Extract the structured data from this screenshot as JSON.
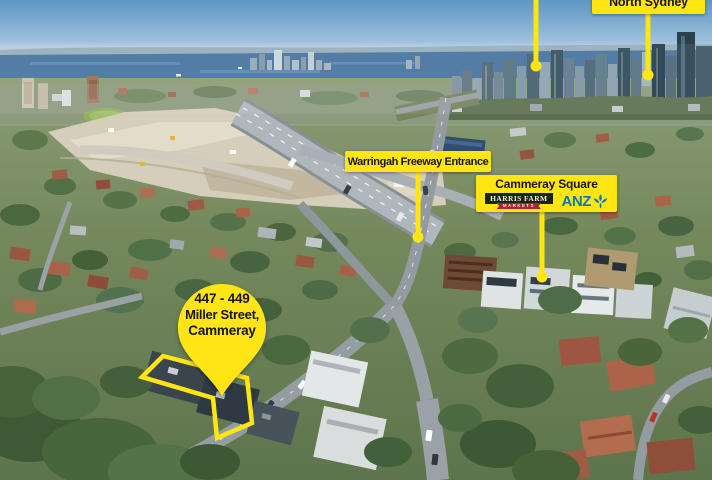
{
  "colors": {
    "callout_yellow": "#FFE512",
    "callout_text": "#151515",
    "anz_blue": "#0C74B8",
    "harris_green": "#16251A",
    "harris_cream": "#F2EBD4",
    "ribbon_red": "#AE2430"
  },
  "callouts": {
    "north_sydney": {
      "label": "North Sydney"
    },
    "warringah_freeway": {
      "label": "Warringah Freeway Entrance"
    },
    "cammeray_square": {
      "title": "Cammeray Square",
      "logo_harris_farm_line1": "HARRIS FARM",
      "logo_harris_farm_line2": "MARKETS",
      "logo_anz": "ANZ"
    },
    "property_pin": {
      "address_line1": "447 - 449",
      "address_line2": "Miller Street,",
      "address_line3": "Cammeray"
    }
  }
}
